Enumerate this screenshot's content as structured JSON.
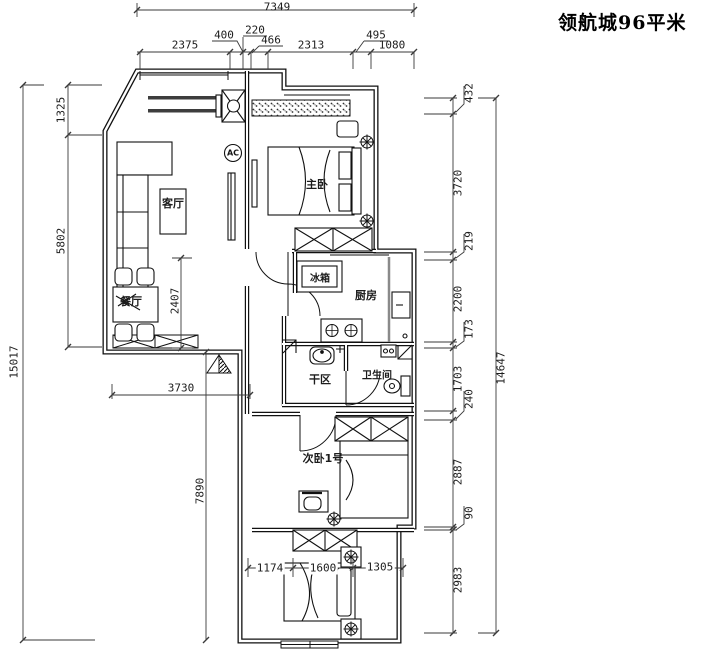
{
  "title": "领航城96平米",
  "labels": {
    "living": "客厅",
    "dining": "餐厅",
    "master": "主卧",
    "fridge": "冰箱",
    "kitchen": "厨房",
    "dry": "干区",
    "bath": "卫生间",
    "bedroom2": "次卧1号",
    "ac": "AC"
  },
  "dims": {
    "top_total": "7349",
    "top": [
      "2375",
      "400",
      "220",
      "466",
      "2313",
      "495",
      "1080"
    ],
    "left_total": "15017",
    "left": [
      "1325",
      "5802",
      "2407"
    ],
    "right_total": "14647",
    "right": [
      "432",
      "3720",
      "219",
      "2200",
      "173",
      "1703",
      "240",
      "2887",
      "90",
      "2983"
    ],
    "bottom": [
      "3730",
      "7890",
      "1174",
      "1600",
      "1305"
    ]
  }
}
